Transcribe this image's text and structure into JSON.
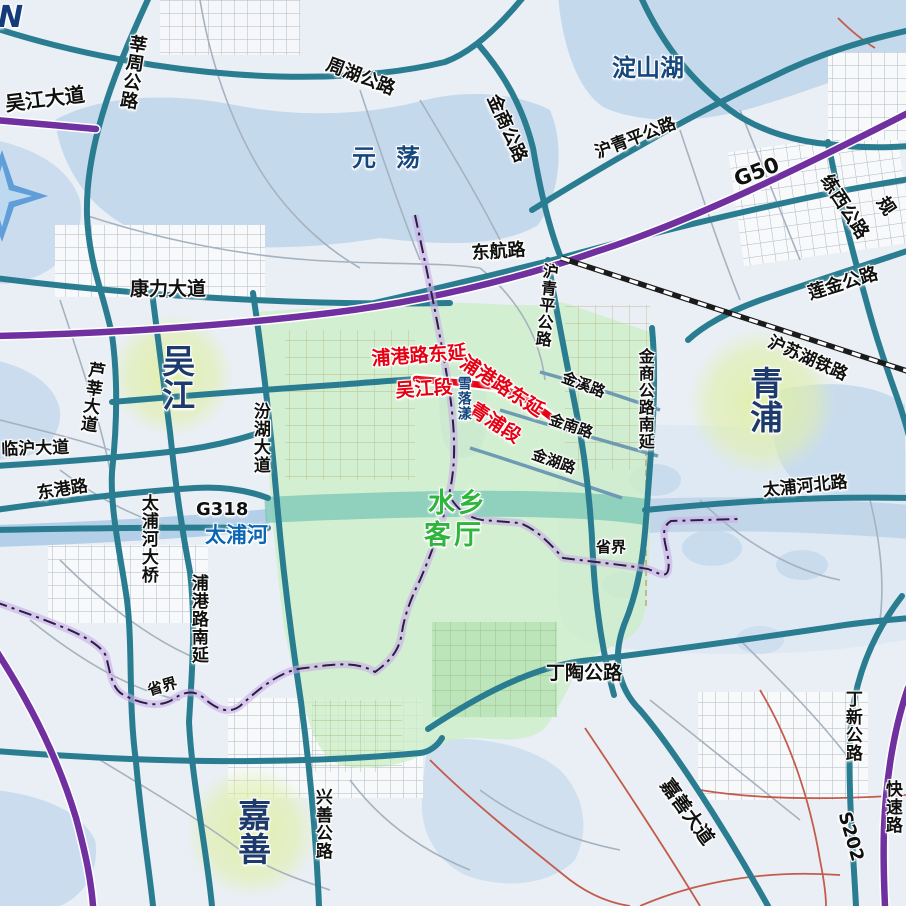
{
  "map": {
    "compass_label": "N",
    "colors": {
      "teal_road": "#2a7d90",
      "expressway_purple": "#7030a0",
      "minor_blue_road": "#6e9ab3",
      "highlight_red": "#e60012",
      "zone_green": "#cdeec6",
      "water_blue": "#c5d9ec",
      "place_navy": "#1c3a6b",
      "river_label_blue": "#0a65b4",
      "zone_text_green": "#2fb53c",
      "railway_black": "#1b1b1b",
      "boundary_glow_purple": "#c9aee6"
    },
    "labels": {
      "roads": {
        "wujiang_dadao": "吴江大道",
        "xinzhou": "莘周公路",
        "zhouhu": "周湖公路",
        "jinshang": "金商公路",
        "huqingping_n": "沪青平公路",
        "g50": "G50",
        "donghang": "东航路",
        "kangli": "康力大道",
        "lianxi": "练西公路",
        "gui_partial": "规",
        "lianjin": "莲金公路",
        "huqingping_e": "沪青平公路",
        "jinxi": "金溪路",
        "jinshang_nanyan": "金商公路南延",
        "jinnan": "金南路",
        "jinhu": "金湖路",
        "taipuhe_beilu": "太浦河北路",
        "g318": "G318",
        "donggang": "东港路",
        "linhu": "临沪大道",
        "luxin": "芦莘大道",
        "fenhu": "汾湖大道",
        "taipuhe_daqiao": "太浦河大桥",
        "pugang_nanyan": "浦港路南延",
        "dingtao": "丁陶公路",
        "xingshan": "兴善公路",
        "jiashan_dadao": "嘉善大道",
        "dingxin": "丁新公路",
        "s202": "S202",
        "kuaisulu": "快速路"
      },
      "railway": {
        "husuhu": "沪苏湖铁路"
      },
      "boundary": {
        "left": "省界",
        "right": "省界"
      },
      "highlight": {
        "dongyan_left": "浦港路东延",
        "wujiang_section": "吴江段",
        "dongyan_right": "浦港路东延",
        "qingpu_section": "青浦段"
      },
      "zone": {
        "line1": "水乡",
        "line2": "客厅"
      },
      "places": {
        "wujiang": "吴江",
        "qingpu": "青浦",
        "jiashan": "嘉善"
      },
      "waters": {
        "yuandang": "元荡",
        "dianshanhu": "淀山湖",
        "xueluoyang": "雪落漾",
        "taipuhe": "太浦河"
      }
    }
  }
}
